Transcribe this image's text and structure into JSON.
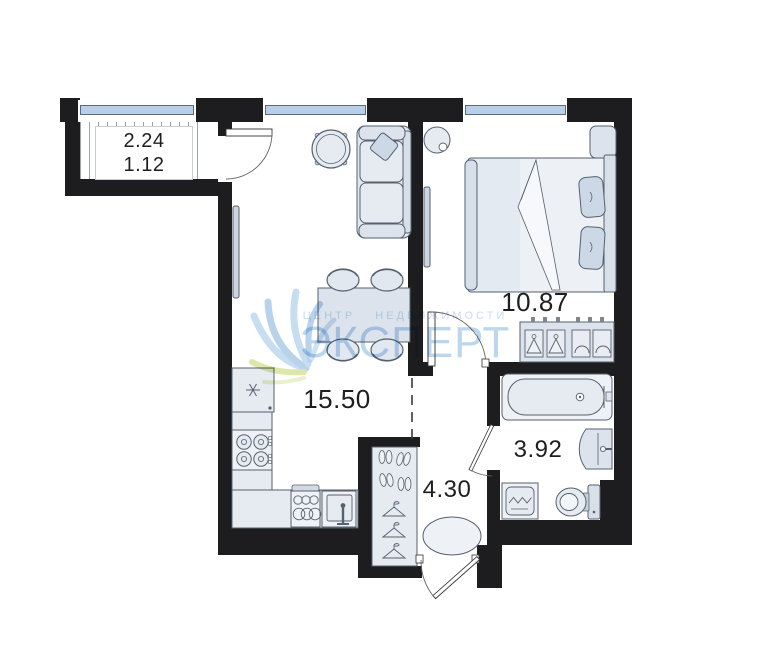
{
  "title": "Apartment floor plan",
  "balcony": {
    "area": "2.24",
    "area_reduced": "1.12"
  },
  "rooms": {
    "living_kitchen": {
      "area": "15.50"
    },
    "bedroom": {
      "area": "10.87"
    },
    "bathroom": {
      "area": "3.92"
    },
    "hallway": {
      "area": "4.30"
    }
  },
  "watermark": {
    "subtitle": "ЦЕНТР НЕДВИЖИМОСТИ",
    "title": "ЭКСПЕРТ"
  },
  "colors": {
    "wall": "#1d1d1f",
    "window_glass": "#b9cfe9",
    "furniture_fill": "#e2e8f0",
    "furniture_stroke": "#55616e",
    "watermark_blue": "#b5d2ec",
    "watermark_green": "#dce7ac",
    "label_text": "#1e1e1e"
  },
  "furniture": [
    "balcony-door",
    "sofa",
    "throw-pillow",
    "round-table",
    "tv-living",
    "dining-table",
    "stool",
    "fridge",
    "stove",
    "kitchen-counter",
    "dish-rack",
    "kitchen-sink",
    "bed",
    "pillow",
    "blanket",
    "nightstand",
    "ceiling-light",
    "tv-bedroom",
    "dresser-wardrobe",
    "bedroom-door",
    "bathtub",
    "washbasin",
    "toilet",
    "washing-machine",
    "bathroom-door",
    "hall-wardrobe",
    "shoes",
    "hanger",
    "rug",
    "entrance-door"
  ]
}
